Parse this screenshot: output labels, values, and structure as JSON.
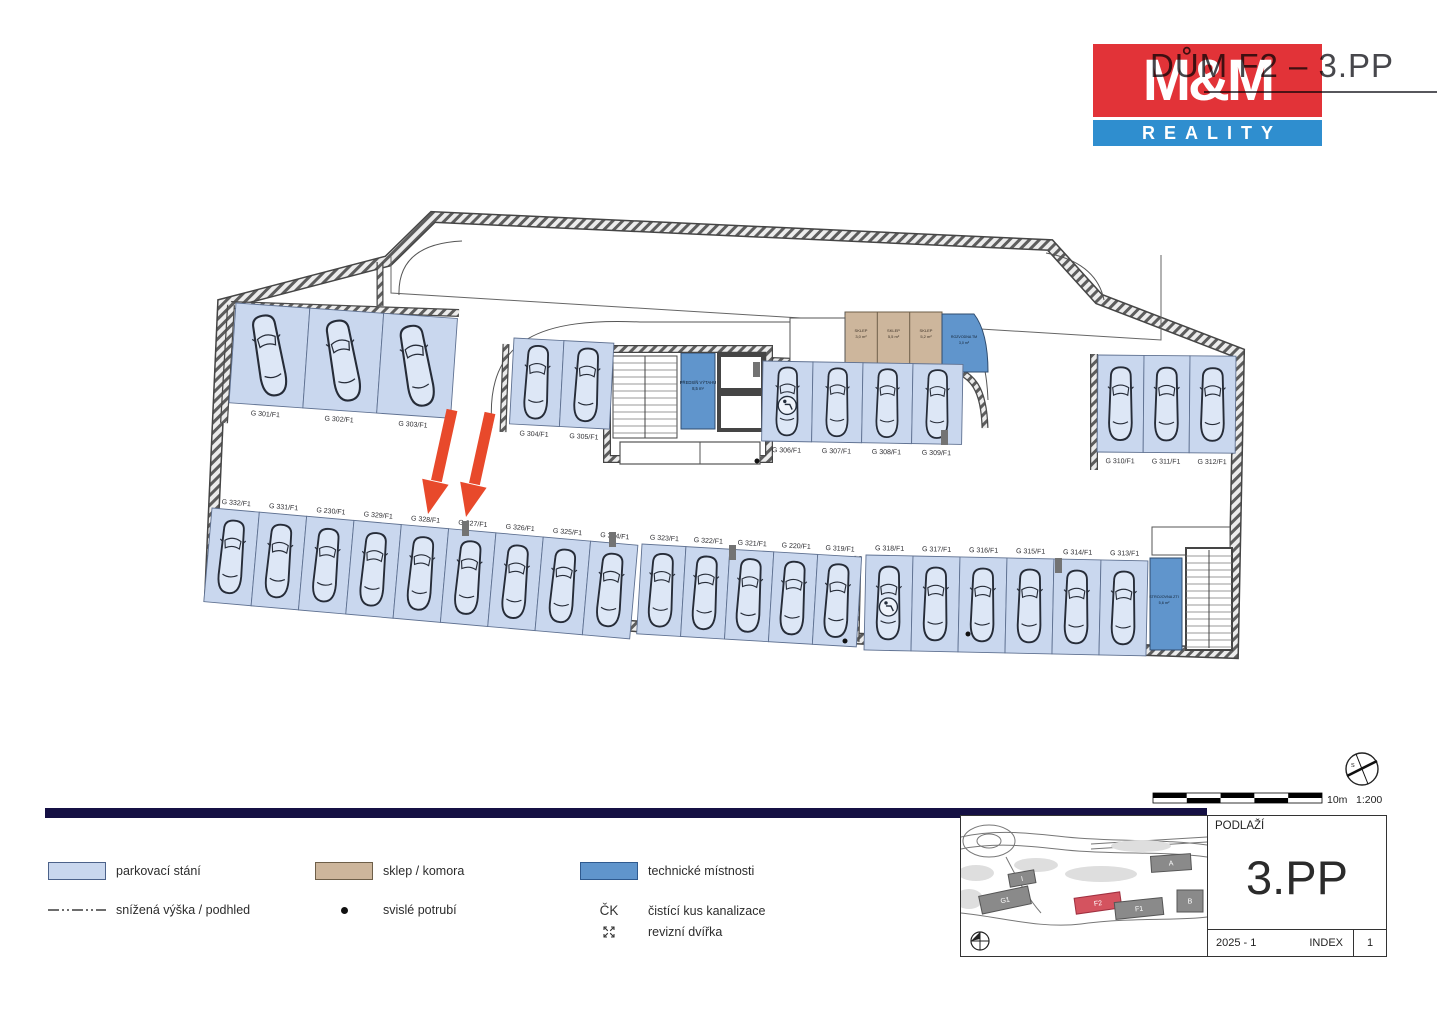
{
  "header": {
    "title": "DŮM F2 – 3.PP",
    "logo_top": "M&M",
    "logo_bottom": "REALITY"
  },
  "plan": {
    "stall_groups": [
      {
        "id": "top-left",
        "labels": [
          "G 301/F1",
          "G 302/F1",
          "G 303/F1"
        ],
        "accessible": []
      },
      {
        "id": "top-mid",
        "labels": [
          "G 304/F1",
          "G 305/F1"
        ],
        "accessible": []
      },
      {
        "id": "top-center-right",
        "labels": [
          "G 306/F1",
          "G 307/F1",
          "G 308/F1",
          "G 309/F1"
        ],
        "accessible": [
          "G 306/F1"
        ]
      },
      {
        "id": "top-right",
        "labels": [
          "G 310/F1",
          "G 311/F1",
          "G 312/F1"
        ],
        "accessible": []
      },
      {
        "id": "bottom-left",
        "labels": [
          "G 332/F1",
          "G 331/F1",
          "G 230/F1",
          "G 329/F1",
          "G 328/F1",
          "G 327/F1",
          "G 326/F1",
          "G 325/F1",
          "G 324/F1"
        ],
        "accessible": []
      },
      {
        "id": "bottom-mid",
        "labels": [
          "G 323/F1",
          "G 322/F1",
          "G 321/F1",
          "G 220/F1",
          "G 319/F1"
        ],
        "accessible": []
      },
      {
        "id": "bottom-right",
        "labels": [
          "G 318/F1",
          "G 317/F1",
          "G 316/F1",
          "G 315/F1",
          "G 314/F1",
          "G 313/F1"
        ],
        "accessible": [
          "G 318/F1"
        ]
      }
    ],
    "rooms": [
      {
        "name": "sklep-1",
        "label": "SKLEP",
        "area": "3,0 m²"
      },
      {
        "name": "sklep-2",
        "label": "SKLEP",
        "area": "5,5 m²"
      },
      {
        "name": "sklep-3",
        "label": "SKLEP",
        "area": "5,2 m²"
      },
      {
        "name": "rozvodna",
        "label": "ROZVODNA TM",
        "area": "3,0 m²"
      },
      {
        "name": "predsin-vytahu",
        "label": "PŘEDSÍŇ VÝTAHU",
        "area": "8,5 m²"
      },
      {
        "name": "strojovna",
        "label": "STROJOVNA ZTI",
        "area": "5,6 m²"
      }
    ],
    "highlighted_stalls": [
      "G 328/F1",
      "G 327/F1"
    ]
  },
  "scalebar": {
    "length_label": "10m",
    "ratio_label": "1:200"
  },
  "legend": {
    "items": [
      {
        "symbol": "parking-swatch",
        "label": "parkovací stání"
      },
      {
        "symbol": "dashdot-line",
        "label": "snížená výška / podhled"
      },
      {
        "symbol": "storage-swatch",
        "label": "sklep / komora"
      },
      {
        "symbol": "dot",
        "label": "svislé potrubí"
      },
      {
        "symbol": "technical-swatch",
        "label": "technické místnosti"
      },
      {
        "symbol": "ck",
        "symbol_text": "ČK",
        "label": "čistící kus kanalizace"
      },
      {
        "symbol": "access-door",
        "label": "revizní dvířka"
      }
    ]
  },
  "titleblock": {
    "floor_label": "PODLAŽÍ",
    "floor_value": "3.PP",
    "revision": "2025 - 1",
    "index_label": "INDEX",
    "index_value": "1",
    "map_buildings": [
      {
        "label": "I"
      },
      {
        "label": "G1"
      },
      {
        "label": "F2",
        "highlight": true
      },
      {
        "label": "F1"
      },
      {
        "label": "A"
      },
      {
        "label": "B"
      }
    ]
  },
  "colors": {
    "parking": "#c9d7ee",
    "storage": "#cdb69c",
    "technical": "#6095cc",
    "arrow": "#e8492b",
    "bar": "#151044",
    "logo_red": "#e23338",
    "logo_blue": "#2f8ecf",
    "highlight_building": "#d4535f"
  }
}
